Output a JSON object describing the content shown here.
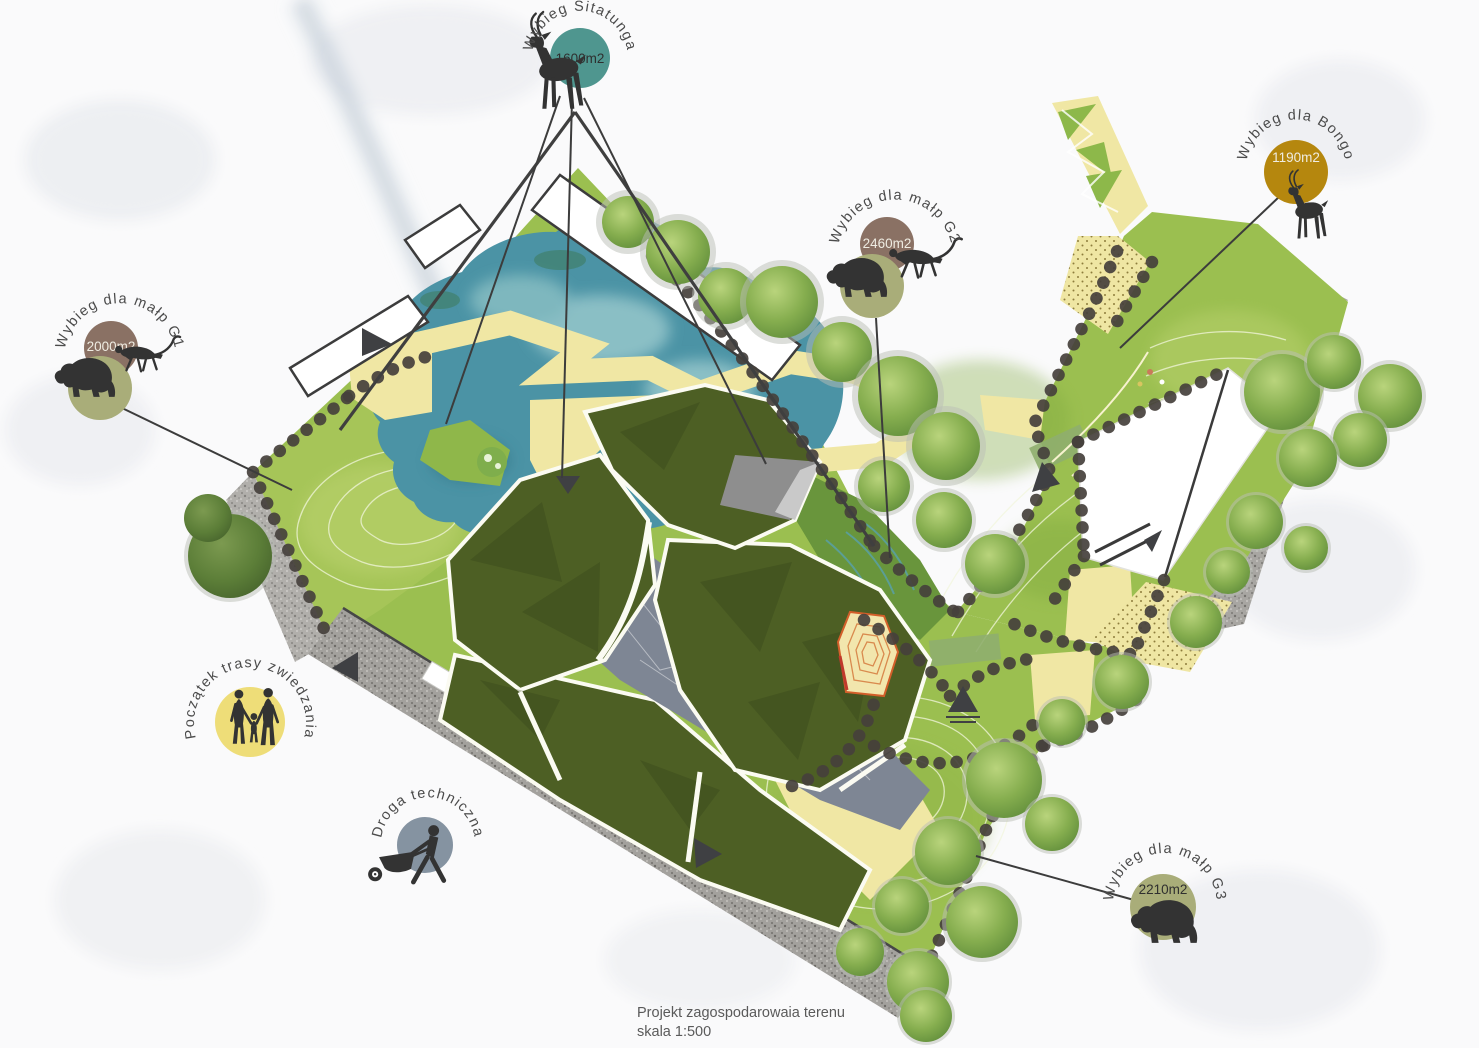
{
  "caption": {
    "line1": "Projekt zagospodarowaia terenu",
    "line2": "skala 1:500"
  },
  "labels": {
    "sitatunga": {
      "title": "Wybieg Sitatunga",
      "area": "1600m2",
      "circle_color": "#4f968f"
    },
    "bongo": {
      "title": "Wybieg dla Bongo",
      "area": "1190m2",
      "circle_color": "#b5870e"
    },
    "g1": {
      "title": "Wybieg dla małp G1",
      "area": "2000m2",
      "area_circle_color": "#8a7164",
      "habitat_circle_color": "#a9ad79"
    },
    "g2": {
      "title": "Wybieg dla małp G2",
      "area": "2460m2",
      "area_circle_color": "#8a7164",
      "habitat_circle_color": "#a9ad79"
    },
    "g3": {
      "title": "Wybieg dla małp G3",
      "area": "2210m2",
      "circle_color": "#a9ad79"
    },
    "route_start": {
      "title": "Początek trasy zwiedzania",
      "circle_color": "#eedd78"
    },
    "service_road": {
      "title": "Droga techniczna",
      "circle_color": "#8593a1"
    }
  },
  "palette": {
    "water": "#4b93a5",
    "grass": "#9bbf50",
    "grass_light": "#a9c75b",
    "roof_green": "#4d5f24",
    "path_yellow": "#f0e7a4",
    "gravel_gray": "#a3a19d",
    "hedge_dark": "#45403c",
    "silhouette": "#333333"
  }
}
